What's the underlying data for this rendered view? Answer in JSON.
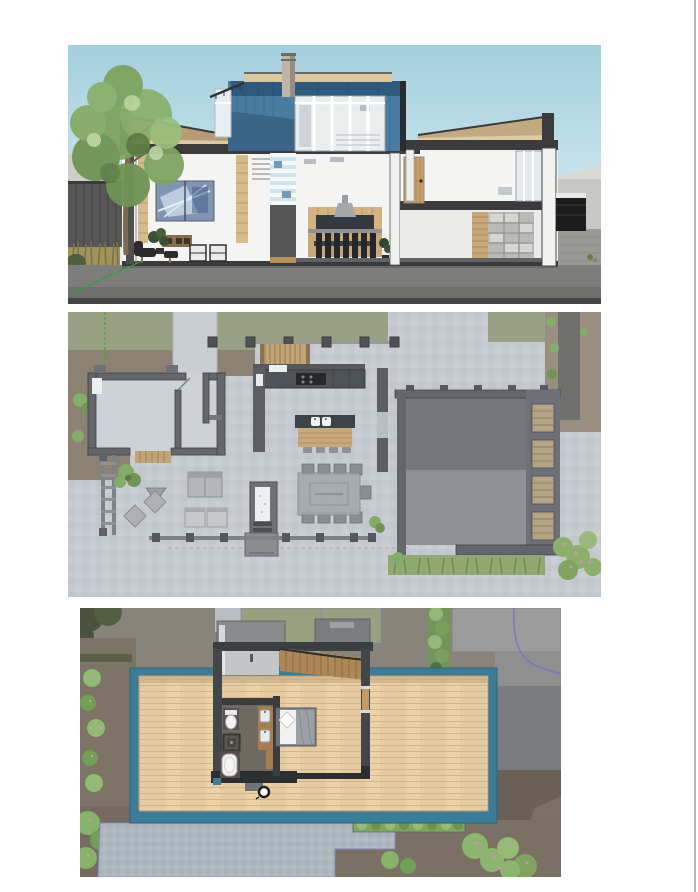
{
  "page": {
    "background": "#ffffff",
    "right_edge_line_color": "#b5b5b5"
  },
  "figures": [
    {
      "id": "section",
      "label": "Cross-section elevation rendering of modern two-story house with tree",
      "type": "architectural-section",
      "palette": {
        "sky": "#a3cfdd",
        "accent_blue_panels": "#4a7ca2",
        "wood_trim": "#dbc89e",
        "structure_charcoal": "#3b3b3b",
        "ground": "#7d7d7b",
        "foliage": "#7ea460",
        "door_wood": "#c89f68",
        "artwork_blue": "#8095b2"
      }
    },
    {
      "id": "floor-plan",
      "label": "Ground floor plan rendering with kitchen island, dining table and terrace",
      "type": "architectural-plan",
      "palette": {
        "pavers": "#c5cad0",
        "walls": "#5b5f63",
        "wood_furniture": "#c7a878",
        "grass": "#99a184",
        "dirt": "#8b8273",
        "lower_roof_dark": "#74787c",
        "lower_roof_light": "#8d9196",
        "hedge": "#8fa971"
      }
    },
    {
      "id": "roof-plan",
      "label": "Upper floor roof deck plan rendering with bedroom suite and bathroom",
      "type": "architectural-plan",
      "palette": {
        "deck_wood": "#e7cba0",
        "deck_border_teal": "#3b7d98",
        "ground_olive": "#89847a",
        "walls": "#44474a",
        "shrubs": "#8cb56d",
        "pavers": "#aeb6be",
        "property_line_blue": "#7272cc"
      }
    }
  ]
}
